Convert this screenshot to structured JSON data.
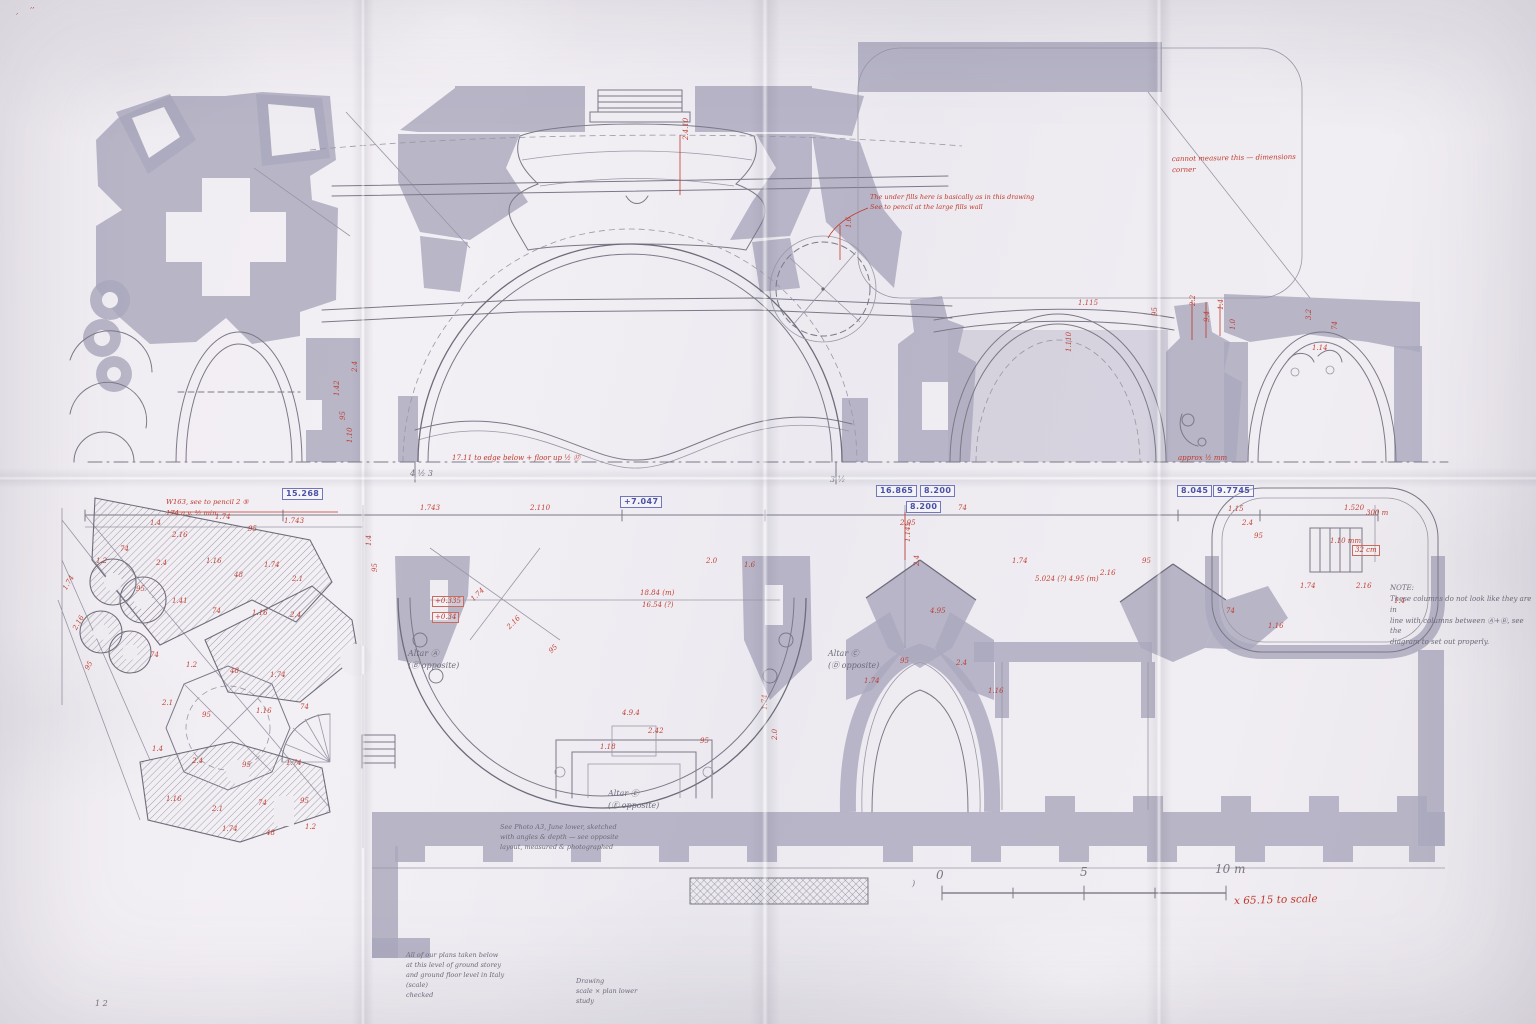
{
  "document_kind": "hand-annotated architectural floor-plan study on folded paper",
  "colors": {
    "paper": "#f0edf2",
    "print_gray": "#aba8bd",
    "pencil": "#76747f",
    "red_ink": "#c0392b",
    "blue_ink": "#4a52a8"
  },
  "scalebar": {
    "t0": "0",
    "t5": "5",
    "t10": "10 m",
    "factor": "x 65.15 to scale",
    "bracket": ")"
  },
  "notes": {
    "right_note": {
      "lines": [
        {
          "t": "NOTE:"
        },
        {
          "t": "These columns do not look like they are in"
        },
        {
          "t": "line with columns between Ⓐ+Ⓑ, see the"
        },
        {
          "t": "diagram to set out properly."
        }
      ]
    },
    "altar_a": {
      "lines": [
        {
          "t": "Altar Ⓐ"
        },
        {
          "t": "(Ⓑ opposite)"
        }
      ]
    },
    "altar_c": {
      "lines": [
        {
          "t": "Altar Ⓒ"
        },
        {
          "t": "(Ⓓ opposite)"
        }
      ]
    },
    "altar_e": {
      "lines": [
        {
          "t": "Altar Ⓔ"
        },
        {
          "t": "(Ⓕ opposite)"
        }
      ]
    },
    "photo_note": {
      "lines": [
        {
          "t": "See Photo A3, June lower, sketched"
        },
        {
          "t": "with angles & depth — see opposite"
        },
        {
          "t": "layout, measured & photographed"
        }
      ]
    },
    "bottom_left_note": {
      "lines": [
        {
          "t": "All of our plans taken below"
        },
        {
          "t": "at this level of ground storey"
        },
        {
          "t": "and ground floor level in Italy"
        },
        {
          "t": "(scale)"
        },
        {
          "t": "checked"
        }
      ]
    },
    "bottom_center_note": {
      "lines": [
        {
          "t": "Drawing"
        },
        {
          "t": "scale × plan lower"
        },
        {
          "t": "study"
        }
      ]
    },
    "red_top_right": {
      "lines": [
        {
          "t": "cannot measure this — dimensions"
        },
        {
          "t": "corner"
        }
      ]
    },
    "red_center": {
      "lines": [
        {
          "t": "The under fills here is basically as in this drawing"
        },
        {
          "t": "See to pencil at the large fills wall"
        }
      ]
    },
    "red_chain_left": {
      "lines": [
        {
          "t": "W163, see to pencil 2 ⑤"
        },
        {
          "t": "174 a.v. ½ min"
        }
      ]
    },
    "red_datum_left": "17.11 to edge below + floor up ½ ⑰",
    "red_datum_right": "approx ½ mm"
  },
  "annotations": {
    "blue_boxes": [
      {
        "x": 282,
        "y": 488,
        "t": "15.268"
      },
      {
        "x": 620,
        "y": 496,
        "t": "+7.047"
      },
      {
        "x": 876,
        "y": 485,
        "t": "16.865"
      },
      {
        "x": 920,
        "y": 485,
        "t": "8.200"
      },
      {
        "x": 906,
        "y": 501,
        "t": "8.200"
      },
      {
        "x": 1177,
        "y": 485,
        "t": "8.045"
      },
      {
        "x": 1213,
        "y": 485,
        "t": "9.7745"
      }
    ],
    "red_boxes": [
      {
        "x": 432,
        "y": 596,
        "t": "+0.335"
      },
      {
        "x": 432,
        "y": 612,
        "t": "+0.34"
      },
      {
        "x": 1352,
        "y": 545,
        "t": "32 cm"
      }
    ],
    "pencil_dims": [
      {
        "x": 410,
        "y": 470,
        "t": "4 ½ 3"
      },
      {
        "x": 830,
        "y": 476,
        "t": "3 ½"
      },
      {
        "x": 95,
        "y": 1000,
        "t": "1 2"
      },
      {
        "x": 912,
        "y": 880,
        "t": ")"
      }
    ],
    "red_dims": [
      {
        "x": 683,
        "y": 140,
        "t": "2.4.10",
        "r": -90
      },
      {
        "x": 846,
        "y": 228,
        "t": "1.6",
        "r": -90
      },
      {
        "x": 1078,
        "y": 300,
        "t": "1.115"
      },
      {
        "x": 1066,
        "y": 352,
        "t": "1.110",
        "r": -90
      },
      {
        "x": 1152,
        "y": 316,
        "t": "95",
        "r": -90
      },
      {
        "x": 1190,
        "y": 306,
        "t": "2.2",
        "r": -90
      },
      {
        "x": 1204,
        "y": 322,
        "t": "9.4",
        "r": -90
      },
      {
        "x": 1218,
        "y": 310,
        "t": "1.4",
        "r": -90
      },
      {
        "x": 1230,
        "y": 330,
        "t": "1.0",
        "r": -90
      },
      {
        "x": 1306,
        "y": 320,
        "t": "3.2",
        "r": -90
      },
      {
        "x": 1312,
        "y": 345,
        "t": "1.14"
      },
      {
        "x": 1332,
        "y": 330,
        "t": "74",
        "r": -90
      },
      {
        "x": 334,
        "y": 396,
        "t": "1.42",
        "r": -90
      },
      {
        "x": 340,
        "y": 420,
        "t": "95",
        "r": -90
      },
      {
        "x": 347,
        "y": 443,
        "t": "1.10",
        "r": -90
      },
      {
        "x": 352,
        "y": 372,
        "t": "2.4",
        "r": -90
      },
      {
        "x": 30,
        "y": 3,
        "t": ",,"
      },
      {
        "x": 16,
        "y": 9,
        "t": ","
      },
      {
        "x": 284,
        "y": 518,
        "t": "1.743"
      },
      {
        "x": 420,
        "y": 505,
        "t": "1.743"
      },
      {
        "x": 530,
        "y": 505,
        "t": "2.110"
      },
      {
        "x": 706,
        "y": 558,
        "t": "2.0"
      },
      {
        "x": 744,
        "y": 562,
        "t": "1.6"
      },
      {
        "x": 900,
        "y": 520,
        "t": "2.95"
      },
      {
        "x": 958,
        "y": 505,
        "t": "74"
      },
      {
        "x": 1035,
        "y": 576,
        "t": "5.024 (?)   4.95 (m)",
        "w": 130
      },
      {
        "x": 1344,
        "y": 505,
        "t": "1.520"
      },
      {
        "x": 1366,
        "y": 510,
        "t": "300 m"
      },
      {
        "x": 1330,
        "y": 538,
        "t": "1.10 mm"
      },
      {
        "x": 1228,
        "y": 506,
        "t": "1.15"
      },
      {
        "x": 1242,
        "y": 520,
        "t": "2.4"
      },
      {
        "x": 1254,
        "y": 533,
        "t": "95"
      },
      {
        "x": 150,
        "y": 520,
        "t": "1.4"
      },
      {
        "x": 172,
        "y": 532,
        "t": "2.16"
      },
      {
        "x": 215,
        "y": 514,
        "t": "1.74"
      },
      {
        "x": 248,
        "y": 526,
        "t": "95"
      },
      {
        "x": 120,
        "y": 546,
        "t": "74"
      },
      {
        "x": 96,
        "y": 558,
        "t": "1.2"
      },
      {
        "x": 156,
        "y": 560,
        "t": "2.4"
      },
      {
        "x": 206,
        "y": 558,
        "t": "1.16"
      },
      {
        "x": 234,
        "y": 572,
        "t": "48"
      },
      {
        "x": 264,
        "y": 562,
        "t": "1.74"
      },
      {
        "x": 292,
        "y": 576,
        "t": "2.1"
      },
      {
        "x": 136,
        "y": 586,
        "t": "95"
      },
      {
        "x": 172,
        "y": 598,
        "t": "1.41"
      },
      {
        "x": 212,
        "y": 608,
        "t": "74"
      },
      {
        "x": 252,
        "y": 610,
        "t": "1.16"
      },
      {
        "x": 290,
        "y": 612,
        "t": "2.4"
      },
      {
        "x": 62,
        "y": 588,
        "t": "1.74",
        "r": -60
      },
      {
        "x": 72,
        "y": 628,
        "t": "2.16",
        "r": -60
      },
      {
        "x": 84,
        "y": 668,
        "t": "95",
        "r": -60
      },
      {
        "x": 150,
        "y": 652,
        "t": "74"
      },
      {
        "x": 186,
        "y": 662,
        "t": "1.2"
      },
      {
        "x": 230,
        "y": 668,
        "t": "48"
      },
      {
        "x": 270,
        "y": 672,
        "t": "1.74"
      },
      {
        "x": 162,
        "y": 700,
        "t": "2.1"
      },
      {
        "x": 202,
        "y": 712,
        "t": "95"
      },
      {
        "x": 256,
        "y": 708,
        "t": "1.16"
      },
      {
        "x": 300,
        "y": 704,
        "t": "74"
      },
      {
        "x": 152,
        "y": 746,
        "t": "1.4"
      },
      {
        "x": 192,
        "y": 758,
        "t": "2.4"
      },
      {
        "x": 242,
        "y": 762,
        "t": "95"
      },
      {
        "x": 286,
        "y": 760,
        "t": "1.74"
      },
      {
        "x": 166,
        "y": 796,
        "t": "1.16"
      },
      {
        "x": 212,
        "y": 806,
        "t": "2.1"
      },
      {
        "x": 258,
        "y": 800,
        "t": "74"
      },
      {
        "x": 300,
        "y": 798,
        "t": "95"
      },
      {
        "x": 222,
        "y": 826,
        "t": "1.74"
      },
      {
        "x": 266,
        "y": 830,
        "t": "48"
      },
      {
        "x": 305,
        "y": 824,
        "t": "1.2"
      },
      {
        "x": 470,
        "y": 598,
        "t": "1.74",
        "r": -45
      },
      {
        "x": 506,
        "y": 626,
        "t": "2.16",
        "r": -45
      },
      {
        "x": 548,
        "y": 650,
        "t": "95",
        "r": -45
      },
      {
        "x": 640,
        "y": 590,
        "t": "18.84 (m)"
      },
      {
        "x": 642,
        "y": 602,
        "t": "16.54 (?)"
      },
      {
        "x": 622,
        "y": 710,
        "t": "4.9.4"
      },
      {
        "x": 648,
        "y": 728,
        "t": "2.42"
      },
      {
        "x": 600,
        "y": 744,
        "t": "1.18"
      },
      {
        "x": 700,
        "y": 738,
        "t": "95"
      },
      {
        "x": 762,
        "y": 710,
        "t": "1.74",
        "r": -90
      },
      {
        "x": 772,
        "y": 740,
        "t": "2.0",
        "r": -90
      },
      {
        "x": 366,
        "y": 546,
        "t": "1.4",
        "r": -90
      },
      {
        "x": 372,
        "y": 572,
        "t": "95",
        "r": -90
      },
      {
        "x": 905,
        "y": 542,
        "t": "1.145",
        "r": -90
      },
      {
        "x": 914,
        "y": 566,
        "t": "2.4",
        "r": -90
      },
      {
        "x": 864,
        "y": 678,
        "t": "1.74"
      },
      {
        "x": 900,
        "y": 658,
        "t": "95"
      },
      {
        "x": 956,
        "y": 660,
        "t": "2.4"
      },
      {
        "x": 988,
        "y": 688,
        "t": "1.16"
      },
      {
        "x": 1012,
        "y": 558,
        "t": "1.74"
      },
      {
        "x": 1100,
        "y": 570,
        "t": "2.16"
      },
      {
        "x": 1142,
        "y": 558,
        "t": "95"
      },
      {
        "x": 930,
        "y": 608,
        "t": "4.95"
      },
      {
        "x": 1300,
        "y": 583,
        "t": "1.74"
      },
      {
        "x": 1356,
        "y": 583,
        "t": "2.16"
      },
      {
        "x": 1394,
        "y": 598,
        "t": "1.4"
      },
      {
        "x": 1226,
        "y": 608,
        "t": "74"
      },
      {
        "x": 1268,
        "y": 623,
        "t": "1.16"
      }
    ]
  }
}
